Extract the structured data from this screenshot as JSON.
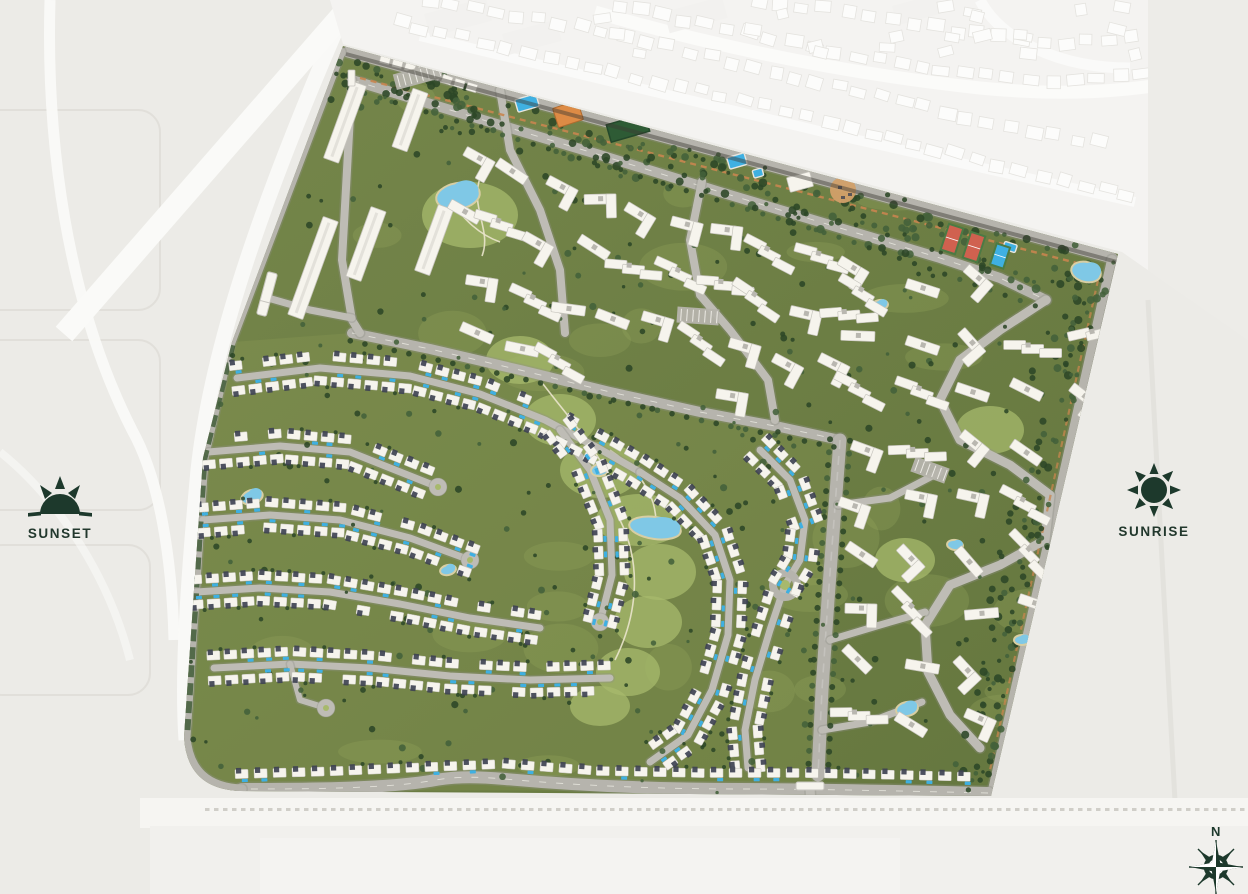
{
  "legend": {
    "sunset_label": "SUNSET",
    "sunrise_label": "SUNRISE"
  },
  "compass": {
    "north_label": "N"
  },
  "palette": {
    "bg": "#ECEBE7",
    "neighbor_line": "#DEDCD7",
    "neighbor_road": "#FAFAF8",
    "highway": "#F6F5F2",
    "site_base": "#76874B",
    "site_base2": "#64763E",
    "lawn": "#96A55C",
    "park": "#A7B96C",
    "tree_dark": "#2C4727",
    "tree_mid": "#43613A",
    "hedge": "#3B5831",
    "road": "#B6B4AD",
    "road_minor": "#BEBCB5",
    "road_case": "#8F8E86",
    "lane": "#E6E4DD",
    "building": "#F6F4ED",
    "building_line": "#C7C5BE",
    "roof_dark": "#3E4253",
    "pool": "#3FB0E2",
    "lake": "#7FC8E6",
    "sand": "#D8CEA2",
    "path_sand": "#EAE4CC",
    "tennis_red": "#D0614F",
    "court_green": "#4C7A44",
    "field_green": "#2E5B35",
    "orange": "#DD8B45",
    "tan": "#D2A069",
    "trail": "#C8854F",
    "tick": "#C9C7C1",
    "accent": "#1D392C"
  }
}
